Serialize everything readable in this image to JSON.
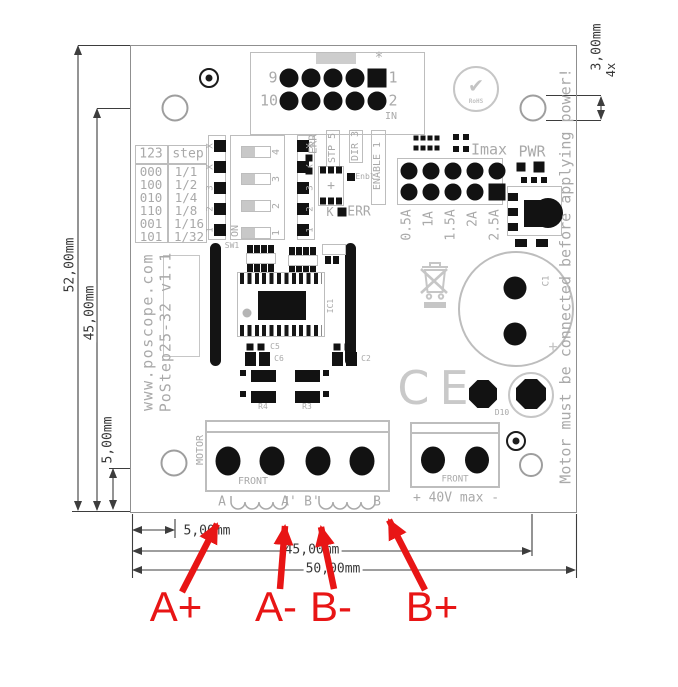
{
  "dims": {
    "h52": "52,00mm",
    "h45": "45,00mm",
    "v5": "5,00mm",
    "b5": "5,00mm",
    "b45": "45,00mm",
    "b50": "50,00mm",
    "hole_dia": "3,00mm",
    "hole_qty": "4x"
  },
  "silk": {
    "site": "www.poscope.com",
    "model": "PoStep25-32 v1.1",
    "warning": "Motor must be connected before applying power!",
    "ce": "CE",
    "rohs": "RoHS",
    "rohs_check_icon": "✔",
    "table": {
      "h1": "123",
      "h2": "step",
      "rows": [
        [
          "000",
          "1/1"
        ],
        [
          "100",
          "1/2"
        ],
        [
          "010",
          "1/4"
        ],
        [
          "110",
          "1/8"
        ],
        [
          "001",
          "1/16"
        ],
        [
          "101",
          "1/32"
        ]
      ]
    },
    "dip": {
      "on": "ON",
      "nums": [
        "4",
        "3",
        "2",
        "1"
      ]
    },
    "jumpers": [
      "X",
      "X",
      "3",
      "2",
      "1"
    ],
    "sig": {
      "err": "ERR",
      "stp": "STP 5",
      "dir": "DIR 3",
      "en": "ENABLE 1",
      "enbl": "Enbl",
      "k": "K",
      "err2": "ERR"
    },
    "hdr": {
      "p9": "9",
      "p10": "10",
      "p1": "1",
      "p2": "2",
      "in_label": "IN",
      "star": "*"
    },
    "imax": {
      "title": "Imax",
      "pwr": "PWR",
      "currents": [
        "0.5A",
        "1A",
        "1.5A",
        "2A",
        "2.5A"
      ]
    },
    "motor": {
      "side": "MOTOR",
      "front": "FRONT",
      "a": "A",
      "a2": "A'",
      "b2": "B'",
      "b": "B"
    },
    "power": {
      "front": "FRONT",
      "rating": "+ 40V max -"
    },
    "ref": {
      "sw1": "SW1",
      "ic1": "IC1",
      "c5": "C5",
      "c6": "C6",
      "c2": "C2",
      "r4": "R4",
      "r3": "R3",
      "c1": "C1",
      "d10": "D10",
      "ic2_plus": "+",
      "c1_plus": "+"
    }
  },
  "annotations": {
    "color": "#e81515",
    "a_plus": "A+",
    "a_minus": "A-",
    "b_minus": "B-",
    "b_plus": "B+"
  }
}
